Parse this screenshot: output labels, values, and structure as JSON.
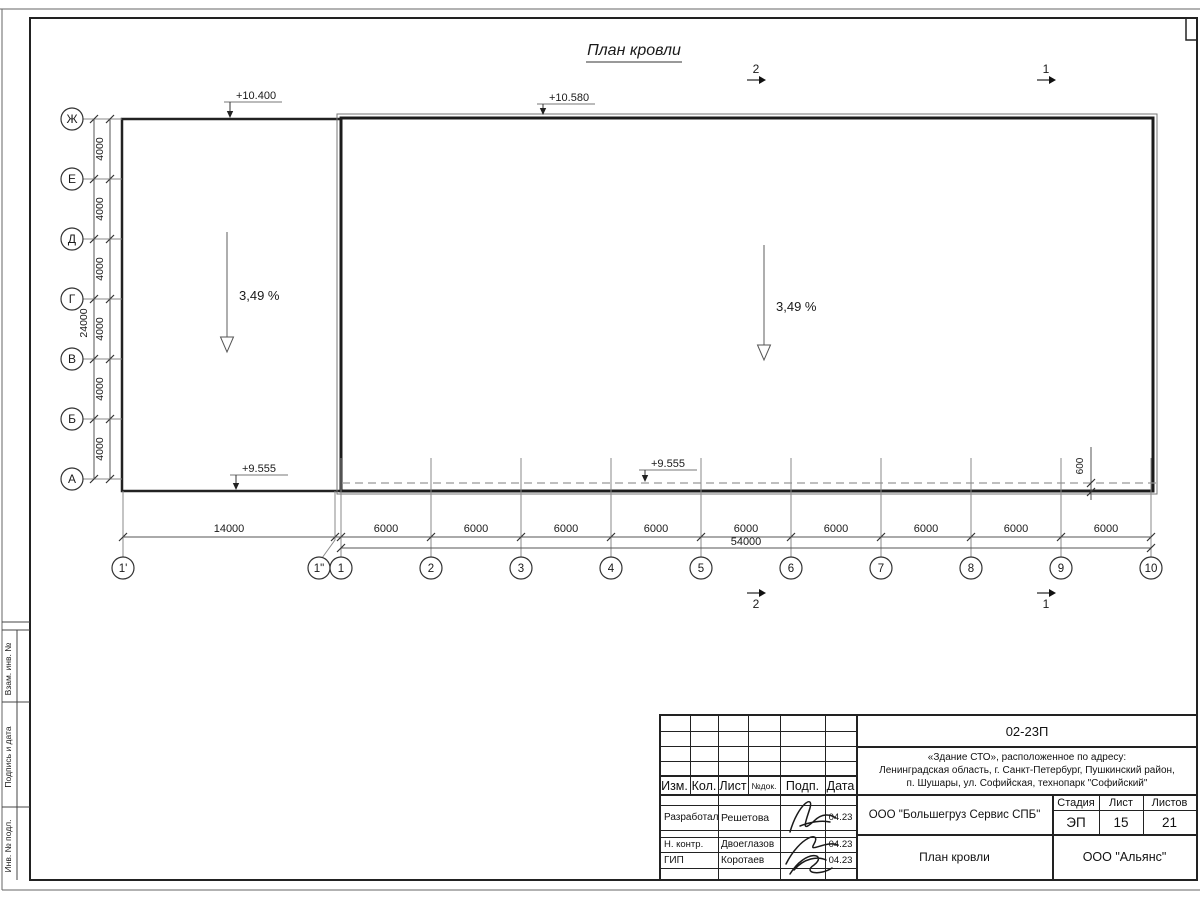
{
  "sheet": {
    "title": "План кровли",
    "frame_left_labels": [
      "Взам. инв. №",
      "Подпись и дата",
      "Инв. № подл."
    ]
  },
  "plan": {
    "row_axis_labels": [
      "Ж",
      "Е",
      "Д",
      "Г",
      "В",
      "Б",
      "А"
    ],
    "col_axis_labels": [
      "1'",
      "1\"",
      "1",
      "2",
      "3",
      "4",
      "5",
      "6",
      "7",
      "8",
      "9",
      "10"
    ],
    "row_dim_segments": [
      "4000",
      "4000",
      "4000",
      "4000",
      "4000",
      "4000"
    ],
    "row_dim_total": "24000",
    "col_dim_segments": [
      "14000",
      "6000",
      "6000",
      "6000",
      "6000",
      "6000",
      "6000",
      "6000",
      "6000",
      "6000"
    ],
    "col_dim_total": "54000",
    "elevations": [
      "+10.400",
      "+10.580",
      "+9.555",
      "+9.555"
    ],
    "slope_labels": [
      "3,49 %",
      "3,49 %"
    ],
    "offset_dim": "600",
    "section_marks": [
      "2",
      "1"
    ]
  },
  "title_block": {
    "doc_number": "02-23П",
    "project": "«Здание СТО», расположенное по адресу:\nЛенинградская область, г. Санкт-Петербург, Пушкинский район,\nп. Шушары, ул. Софийская, технопарк \"Софийский\"",
    "header_cells": [
      "Изм.",
      "Кол.",
      "Лист",
      "№док.",
      "Подп.",
      "Дата"
    ],
    "roles": [
      {
        "role": "Разработал",
        "name": "Решетова",
        "date": "04.23"
      },
      {
        "role": "Н. контр.",
        "name": "Двоеглазов",
        "date": "04.23"
      },
      {
        "role": "ГИП",
        "name": "Коротаев",
        "date": "04.23"
      }
    ],
    "company": "ООО \"Большегруз Сервис СПБ\"",
    "sheet_title": "План кровли",
    "org": "ООО \"Альянс\"",
    "stage_label": "Стадия",
    "stage": "ЭП",
    "sheet_label": "Лист",
    "sheet_num": "15",
    "sheets_label": "Листов",
    "sheets_total": "21"
  }
}
